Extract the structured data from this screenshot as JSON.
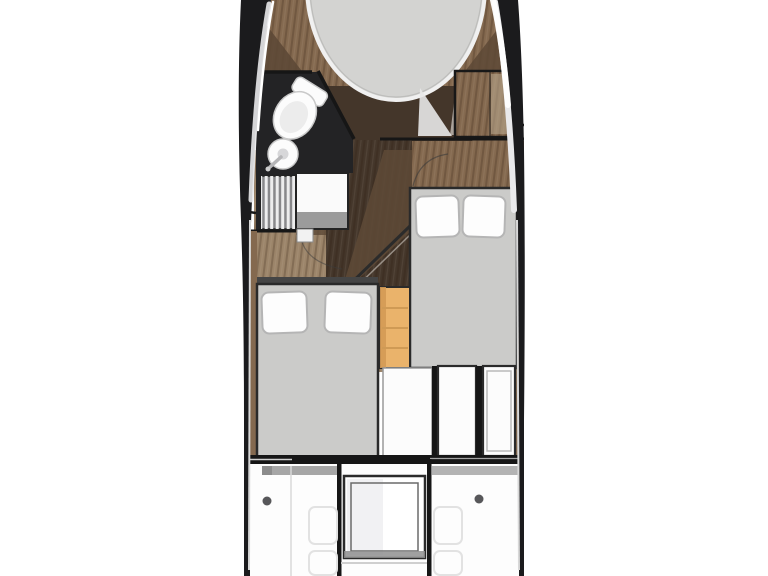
{
  "scene": {
    "type": "yacht-interior-floorplan",
    "orientation": "bow-up",
    "visible_text": "none"
  },
  "palette": {
    "bg": "#ffffff",
    "hull": "#1b1b1d",
    "chrome": "#e9e9eb",
    "chrome_bright": "#ffffff",
    "wood_light": "#9b8469",
    "wood_mid": "#84694f",
    "wood_dark": "#5d4936",
    "wood_deep": "#44362a",
    "head_floor": "#232325",
    "bed_grey": "#cbcbc9",
    "bed_stroke": "#2a2a2a",
    "pillow": "#fdfdfd",
    "pillow_stroke": "#b5b5b5",
    "orange": "#eab36b",
    "orange_dark": "#d49a55",
    "panel": "#fcfcfc",
    "line": "#161616",
    "cockpit_line": "#e2e2e2",
    "vberth_grey": "#d3d3d1",
    "counter_grey": "#9b9b9b"
  },
  "elements": {
    "hull": [
      "hull-port-side",
      "hull-starboard-side",
      "chrome-rubbing-strake"
    ],
    "bow": [
      "foredeck-wood",
      "v-berth-bed"
    ],
    "head": [
      "head-floor",
      "toilet",
      "sink",
      "faucet",
      "shower-grate",
      "vanity-counter"
    ],
    "salon": [
      "salon-floor",
      "companionway-column",
      "stairs-diagonal",
      "door-swing-arc",
      "wardrobe"
    ],
    "cabins": [
      "port-cabin-bed",
      "port-cabin-pillows",
      "starboard-cabin-bed",
      "starboard-cabin-pillows",
      "companionway-steps"
    ],
    "aft": [
      "aft-cabinet-panels",
      "transom-bulkhead"
    ],
    "cockpit": [
      "cockpit-sole",
      "engine-hatch",
      "deck-drain-dots",
      "seat-outline-stitching"
    ]
  }
}
